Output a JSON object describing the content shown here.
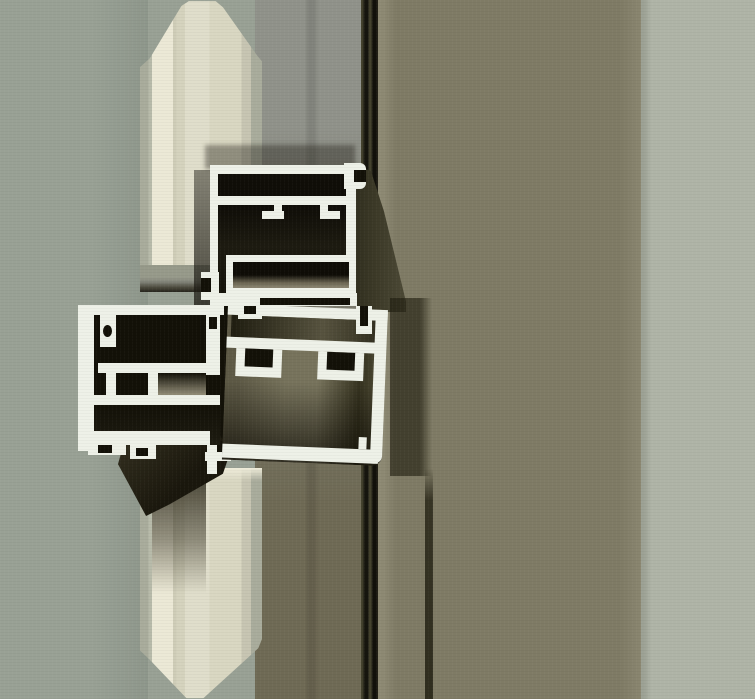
{
  "meta": {
    "description": "Product photograph: cut-away cross-section of an aluminium curtain-wall mullion and transom profile system clamping a beveled glass/composite panel edge",
    "image_type": "photograph",
    "width_px": 755,
    "height_px": 699
  },
  "scene": {
    "subject": "aluminium-profile-cross-section",
    "elements": [
      "beveled-panel-edge",
      "transom-profile-cross-section",
      "mullion-box-profile-cross-section",
      "glazing-gasket-wedge",
      "dark-pressure-plate-stripe",
      "mullion-side-face",
      "background-wall"
    ]
  },
  "colors": {
    "bg_left": "#99a195",
    "bg_left_shade": "#8e978b",
    "band_mid_top": "#90928a",
    "band_mid_mid": "#7c7b6d",
    "band_mid_bottom": "#6f6a55",
    "stripe_dark": "#16150e",
    "stripe_light": "#45432f",
    "olive": "#7f7b65",
    "olive_edge": "#8d8973",
    "bg_light": "#afb4a7",
    "panel_edge": "#a9ac9c",
    "panel_bright": "#ece9d6",
    "panel_mid": "#d5d3be",
    "panel_face": "#e0decb",
    "panel_shade": "#c7c5b2",
    "bevel_gray": "#979a8a",
    "bevel_dark": "#26241c",
    "alu": "#eef1e8",
    "alu_dim": "#d3d8ca",
    "chamber": "#131108",
    "chamber_soft": "#1d1b11",
    "box_in_light": "#77735c",
    "box_in_mid": "#5e5a46",
    "box_in_dark": "#35321f",
    "recess_dark": "#1f1d10",
    "gasket": "#1a170d",
    "wedge_light": "#383423",
    "beige_reflect": "#8d8873"
  }
}
